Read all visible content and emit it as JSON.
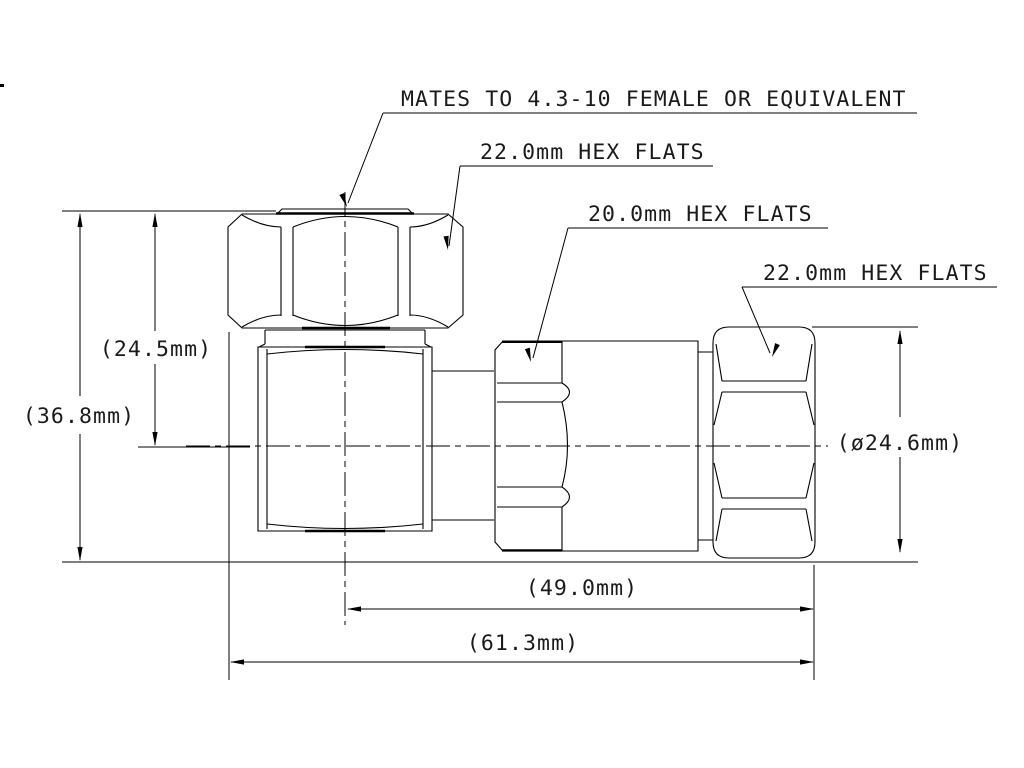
{
  "drawing": {
    "note": "MATES TO 4.3-10 FEMALE OR EQUIVALENT",
    "callouts": {
      "top_hex": "22.0mm HEX FLATS",
      "middle_hex": "20.0mm HEX FLATS",
      "right_hex": "22.0mm HEX FLATS"
    },
    "dimensions": {
      "center_height": "(24.5mm)",
      "overall_height": "(36.8mm)",
      "coupling_nut_diameter": "(ø24.6mm)",
      "center_to_end_length": "(49.0mm)",
      "overall_length": "(61.3mm)"
    },
    "colors": {
      "line": "#000000",
      "background": "#ffffff"
    }
  }
}
